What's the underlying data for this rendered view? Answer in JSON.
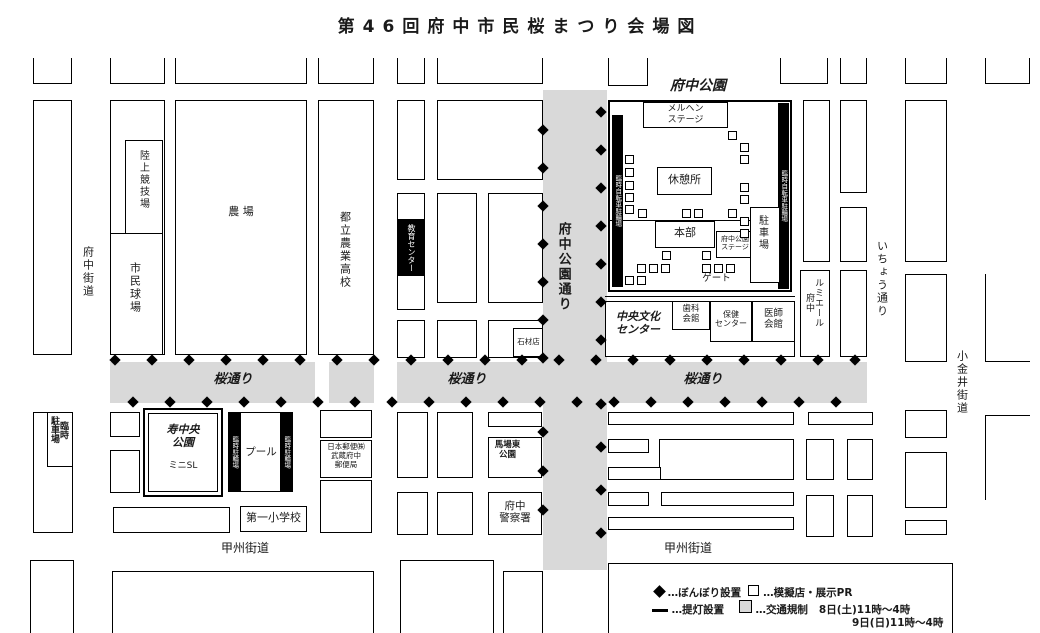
{
  "title": "第46回府中市民桜まつり会場図",
  "colors": {
    "road_shading": "#d9d9d9",
    "line": "#000000",
    "background": "#ffffff"
  },
  "roads": {
    "fuchu_kaido": "府中街道",
    "fuchu_koen_dori": "府中公園通り",
    "sakura_dori_left": "桜通り",
    "sakura_dori_mid": "桜通り",
    "sakura_dori_right": "桜通り",
    "icho_dori": "いちょう通り",
    "koganei_kaido": "小金井街道",
    "koshu_kaido_left": "甲州街道",
    "koshu_kaido_right": "甲州街道"
  },
  "places": {
    "rikujo_kyogijo": "陸上競技場",
    "shimin_kyujo": "市民球場",
    "nojo": "農 場",
    "toritsu_nogyo_koko": "都立農業高校",
    "kyoiku_center": "教育センター",
    "sekizaiten": "石材店",
    "fuchu_koen": "府中公園",
    "marchen_stage": "メルヘン\nステージ",
    "kyukeijo": "休憩所",
    "honbu": "本部",
    "fuchu_koen_stage": "府中公園\nステージ",
    "gate": "ゲート",
    "chushajo": "駐車場",
    "rinji_jitensha_churinjo_left": "臨時自転車駐輪場",
    "rinji_jitensha_churinjo_right": "臨時自転車駐輪場",
    "chuo_bunka_center": "中央文化\nセンター",
    "shika_kaikan": "歯科\n会館",
    "hoken_center": "保健\nセンター",
    "ishi_kaikan": "医師\n会館",
    "lumiere_fuchu": "ルミエール\n府中",
    "rinji_chushajo": "臨時\n駐車場",
    "kotobuki_chuo_koen": "寿中央\n公園",
    "mini_sl": "ミニSL",
    "rinji_churinjo_1": "臨時駐輪場",
    "rinji_churinjo_2": "臨時駐輪場",
    "pool": "プール",
    "daiichi_shogakko": "第一小学校",
    "post_office": "日本郵便㈱\n武蔵府中\n郵便局",
    "babahigashi_koen": "馬場東\n公園",
    "fuchu_keisatsusho": "府中\n警察署"
  },
  "legend": {
    "bonbori_label": "…ぼんぼり設置",
    "mogiten_label": "…模擬店・展示PR",
    "chochin_label": "…提灯設置",
    "kisei_label": "…交通規制",
    "kisei_time1": "8日(土)11時～4時",
    "kisei_time2": "9日(日)11時～4時"
  },
  "bonbori_runs": [
    {
      "x": 115,
      "y": 360,
      "dx": 37,
      "dy": 0,
      "count": 21
    },
    {
      "x": 133,
      "y": 402,
      "dx": 37,
      "dy": 0,
      "count": 20
    },
    {
      "x": 543,
      "y": 130,
      "dx": 0,
      "dy": 38,
      "count": 7
    },
    {
      "x": 601,
      "y": 112,
      "dx": 0,
      "dy": 38,
      "count": 7
    },
    {
      "x": 543,
      "y": 432,
      "dx": 0,
      "dy": 39,
      "count": 3
    },
    {
      "x": 601,
      "y": 404,
      "dx": 0,
      "dy": 43,
      "count": 4
    }
  ],
  "stall_squares": [
    [
      625,
      155
    ],
    [
      625,
      168
    ],
    [
      625,
      181
    ],
    [
      625,
      193
    ],
    [
      625,
      205
    ],
    [
      728,
      131
    ],
    [
      740,
      143
    ],
    [
      740,
      155
    ],
    [
      740,
      183
    ],
    [
      740,
      195
    ],
    [
      740,
      217
    ],
    [
      740,
      229
    ],
    [
      638,
      209
    ],
    [
      682,
      209
    ],
    [
      694,
      209
    ],
    [
      728,
      209
    ],
    [
      662,
      251
    ],
    [
      702,
      251
    ],
    [
      637,
      264
    ],
    [
      649,
      264
    ],
    [
      661,
      264
    ],
    [
      702,
      264
    ],
    [
      714,
      264
    ],
    [
      726,
      264
    ],
    [
      625,
      276
    ],
    [
      637,
      276
    ]
  ]
}
